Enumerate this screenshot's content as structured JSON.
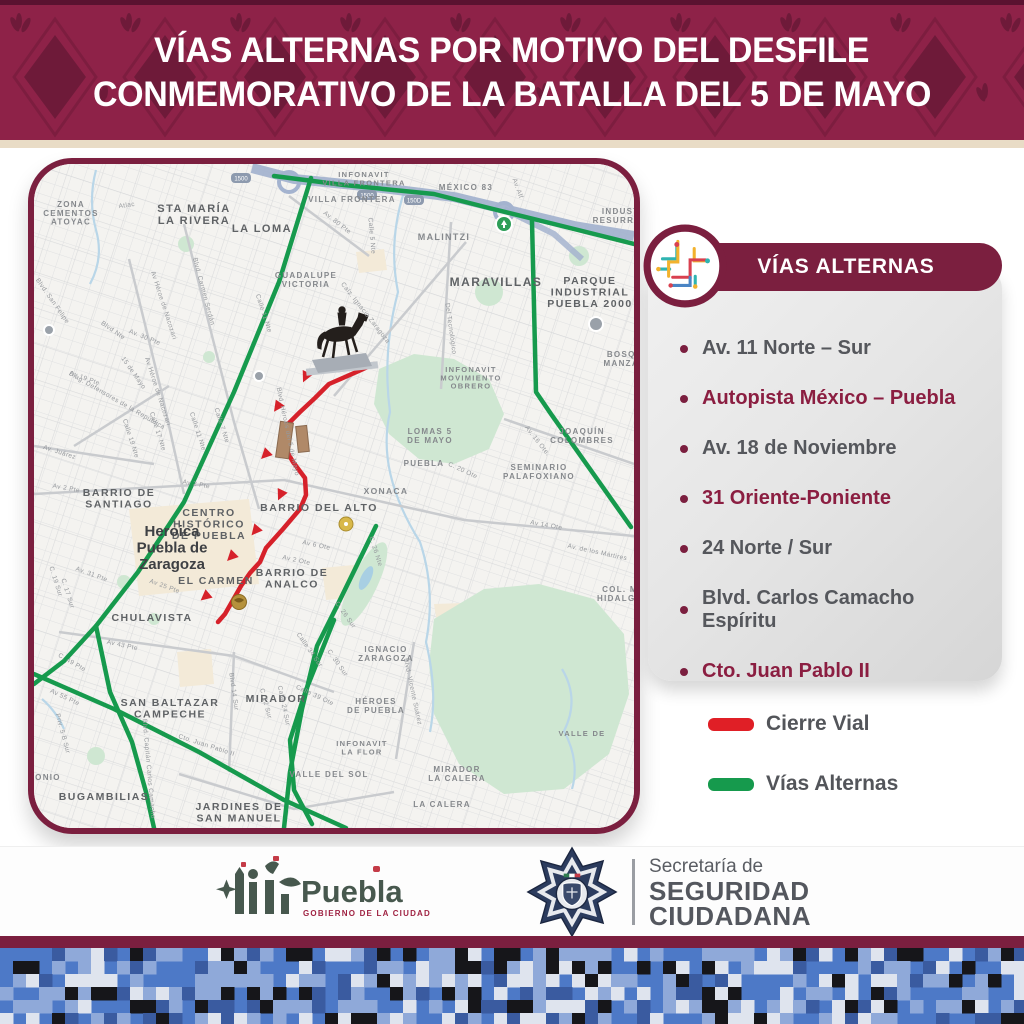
{
  "colors": {
    "maroon": "#7B1F3F",
    "header_bg": "#8E2248",
    "header_pattern": "#6E1A39",
    "cream": "#E9DCC6",
    "closure_red": "#D6212A",
    "alternate_green": "#169A4D",
    "map_bg": "#f4f3f0"
  },
  "header": {
    "title_line1": "VÍAS ALTERNAS POR MOTIVO DEL DESFILE",
    "title_line2": "CONMEMORATIVO DE LA BATALLA DEL 5 DE MAYO"
  },
  "panel": {
    "title": "VÍAS ALTERNAS",
    "items": [
      {
        "label": "Av. 11 Norte – Sur",
        "highlight": false
      },
      {
        "label": "Autopista México – Puebla",
        "highlight": true
      },
      {
        "label": "Av. 18 de Noviembre",
        "highlight": false
      },
      {
        "label": "31 Oriente-Poniente",
        "highlight": true
      },
      {
        "label": "24 Norte / Sur",
        "highlight": false
      },
      {
        "label": "Blvd. Carlos Camacho Espíritu",
        "highlight": false
      },
      {
        "label": "Cto. Juan Pablo II",
        "highlight": true
      }
    ]
  },
  "legend": [
    {
      "label": "Cierre Vial",
      "color": "#E01F26"
    },
    {
      "label": "Vías Alternas",
      "color": "#169A4D"
    }
  ],
  "footer": {
    "puebla": {
      "name": "Puebla",
      "subtitle": "GOBIERNO DE LA CIUDAD"
    },
    "ssc": {
      "line1": "Secretaría de",
      "line2": "SEGURIDAD",
      "line3": "CIUDADANA"
    }
  },
  "map": {
    "city": {
      "t": "Heroica\nPuebla de\nZaragoza",
      "x": 138,
      "y": 372,
      "s": 15
    },
    "routes": {
      "closed": {
        "color": "#D6212A",
        "points": "340,200 327,206 295,220 281,234 266,248 250,264 251,284 259,298 271,314 272,331 266,345 249,365 232,384 226,398 216,409 207,422 199,436 191,450 184,458"
      },
      "arrows": [
        [
          272,
          212,
          205
        ],
        [
          244,
          242,
          215
        ],
        [
          232,
          290,
          225
        ],
        [
          247,
          330,
          205
        ],
        [
          222,
          366,
          220
        ],
        [
          198,
          392,
          225
        ],
        [
          172,
          432,
          230
        ]
      ],
      "alternate": {
        "color": "#169A4D",
        "lines": [
          "240,12 310,21 400,30 455,44 520,60 600,80",
          "498,57 502,228 517,250 597,363",
          "277,14 245,118 200,228 150,338 104,408 62,462 30,497 0,520",
          "62,462 76,528 98,578 112,628 120,664",
          "0,510 80,545 165,588 250,636 312,664",
          "342,362 302,444 283,482 268,545 256,608 250,664",
          "300,456 272,526 256,576 260,626 278,660"
        ]
      }
    },
    "areas": [
      {
        "t": "ZONA\nCEMENTOS\nATOYAC",
        "x": 37,
        "y": 43,
        "s": 8
      },
      {
        "t": "STA MARÍA\nLA RIVERA",
        "x": 160,
        "y": 48,
        "s": 11,
        "b": 1
      },
      {
        "t": "LA LOMA",
        "x": 228,
        "y": 68,
        "s": 11,
        "b": 1
      },
      {
        "t": "INFONAVIT\nVILLA FRONTERA",
        "x": 330,
        "y": 13,
        "s": 7.5
      },
      {
        "t": "VILLA FRONTERA",
        "x": 318,
        "y": 38,
        "s": 8
      },
      {
        "t": "MÉXICO 83",
        "x": 432,
        "y": 26,
        "s": 8
      },
      {
        "t": "MALINTZI",
        "x": 410,
        "y": 76,
        "s": 9
      },
      {
        "t": "MARAVILLAS",
        "x": 462,
        "y": 122,
        "s": 12,
        "b": 1
      },
      {
        "t": "PARQUE\nINDUSTRIAL\nPUEBLA 2000",
        "x": 556,
        "y": 120,
        "s": 10.5,
        "b": 1
      },
      {
        "t": "INDUST.\nRESURREC.",
        "x": 588,
        "y": 50,
        "s": 8
      },
      {
        "t": "GUADALUPE\nVICTORIA",
        "x": 272,
        "y": 114,
        "s": 8
      },
      {
        "t": "BOSQ.\nMANZA.",
        "x": 589,
        "y": 193,
        "s": 8
      },
      {
        "t": "JOAQUÍN\nCOLOMBRES",
        "x": 548,
        "y": 270,
        "s": 8
      },
      {
        "t": "LOMAS 5\nDE MAYO",
        "x": 396,
        "y": 270,
        "s": 8
      },
      {
        "t": "PUEBLA",
        "x": 390,
        "y": 302,
        "s": 8
      },
      {
        "t": "XONACA",
        "x": 352,
        "y": 330,
        "s": 8.5
      },
      {
        "t": "SEMINARIO\nPALAFOXIANO",
        "x": 505,
        "y": 306,
        "s": 8
      },
      {
        "t": "INFONAVIT\nMOVIMIENTO\nOBRERO",
        "x": 437,
        "y": 208,
        "s": 7.5
      },
      {
        "t": "BARRIO DEL ALTO",
        "x": 285,
        "y": 347,
        "s": 10.5,
        "b": 1
      },
      {
        "t": "CENTRO\nHISTÓRICO\nDE PUEBLA",
        "x": 175,
        "y": 352,
        "s": 10.5,
        "b": 1
      },
      {
        "t": "BARRIO DE\nSANTIAGO",
        "x": 85,
        "y": 332,
        "s": 10.5,
        "b": 1
      },
      {
        "t": "EL CARMEN",
        "x": 182,
        "y": 420,
        "s": 10.5,
        "b": 1
      },
      {
        "t": "BARRIO DE\nANALCO",
        "x": 258,
        "y": 412,
        "s": 10.5,
        "b": 1
      },
      {
        "t": "CHULAVISTA",
        "x": 118,
        "y": 457,
        "s": 10.5,
        "b": 1
      },
      {
        "t": "SAN BALTAZAR\nCAMPECHE",
        "x": 136,
        "y": 542,
        "s": 10.5,
        "b": 1
      },
      {
        "t": "MIRADOR",
        "x": 242,
        "y": 538,
        "s": 10.5,
        "b": 1
      },
      {
        "t": "BUGAMBILIAS",
        "x": 70,
        "y": 636,
        "s": 10.5,
        "b": 1
      },
      {
        "t": "JARDINES DE\nSAN MANUEL",
        "x": 205,
        "y": 646,
        "s": 10.5,
        "b": 1
      },
      {
        "t": "IGNACIO\nZARAGOZA",
        "x": 352,
        "y": 488,
        "s": 8
      },
      {
        "t": "HÉROES\nDE PUEBLA",
        "x": 342,
        "y": 540,
        "s": 8
      },
      {
        "t": "INFONAVIT\nLA FLOR",
        "x": 328,
        "y": 582,
        "s": 7.5
      },
      {
        "t": "VALLE DEL SOL",
        "x": 295,
        "y": 613,
        "s": 8
      },
      {
        "t": "MIRADOR\nLA CALERA",
        "x": 423,
        "y": 608,
        "s": 8
      },
      {
        "t": "LA CALERA",
        "x": 408,
        "y": 643,
        "s": 8
      },
      {
        "t": "COL. M\nHIDALGO",
        "x": 586,
        "y": 428,
        "s": 8
      },
      {
        "t": "VALLE DE",
        "x": 548,
        "y": 572,
        "s": 7.5
      },
      {
        "t": "MONIO",
        "x": 10,
        "y": 616,
        "s": 8
      }
    ],
    "streets": [
      {
        "t": "Atlac",
        "x": 93,
        "y": 43,
        "r": -8
      },
      {
        "t": "Av. 80 Pte",
        "x": 302,
        "y": 60,
        "r": 38
      },
      {
        "t": "Calle 5 Nte",
        "x": 336,
        "y": 72,
        "r": 85
      },
      {
        "t": "Blvd. Carmen Serdán",
        "x": 168,
        "y": 128,
        "r": 75
      },
      {
        "t": "Calle 11 Nte",
        "x": 228,
        "y": 150,
        "r": 72
      },
      {
        "t": "Av Héroe de Nacozari",
        "x": 128,
        "y": 142,
        "r": 72
      },
      {
        "t": "Blvd. San Felipe",
        "x": 17,
        "y": 138,
        "r": 55
      },
      {
        "t": "Blvd Nte",
        "x": 78,
        "y": 168,
        "r": 35
      },
      {
        "t": "Av. 30 Pte",
        "x": 110,
        "y": 175,
        "r": 22
      },
      {
        "t": "15 de Mayo",
        "x": 98,
        "y": 210,
        "r": 55
      },
      {
        "t": "Av 19 Pte",
        "x": 50,
        "y": 216,
        "r": 20
      },
      {
        "t": "Calle 11 Nte",
        "x": 162,
        "y": 268,
        "r": 72
      },
      {
        "t": "Av Héroe de Nacozari",
        "x": 122,
        "y": 228,
        "r": 72
      },
      {
        "t": "Calle 7 Nte",
        "x": 186,
        "y": 262,
        "r": 72
      },
      {
        "t": "Calle 17 Nte",
        "x": 122,
        "y": 268,
        "r": 72
      },
      {
        "t": "Calle 19 Nte",
        "x": 95,
        "y": 275,
        "r": 72
      },
      {
        "t": "Diag. Defensores de la República",
        "x": 82,
        "y": 238,
        "r": 30
      },
      {
        "t": "Av. Juárez",
        "x": 25,
        "y": 290,
        "r": 18
      },
      {
        "t": "Av 2 Pte",
        "x": 32,
        "y": 326,
        "r": 10
      },
      {
        "t": "Av 2 Pte",
        "x": 162,
        "y": 322,
        "r": 10
      },
      {
        "t": "Blvd. Héroes del 5 de Mayo",
        "x": 252,
        "y": 268,
        "r": 78
      },
      {
        "t": "Calz. Ignacio Zaragoza",
        "x": 330,
        "y": 150,
        "r": 52
      },
      {
        "t": "Del Tecnológico",
        "x": 415,
        "y": 165,
        "r": 82
      },
      {
        "t": "Av. Alf",
        "x": 482,
        "y": 25,
        "r": 70
      },
      {
        "t": "C. 20 Ote",
        "x": 428,
        "y": 308,
        "r": 25
      },
      {
        "t": "Av. 16 Ote.",
        "x": 502,
        "y": 278,
        "r": 52
      },
      {
        "t": "Av 14 Ote",
        "x": 512,
        "y": 363,
        "r": 10
      },
      {
        "t": "Av. de los Mártires",
        "x": 563,
        "y": 390,
        "r": 12
      },
      {
        "t": "C. 26 Nte",
        "x": 340,
        "y": 388,
        "r": 72
      },
      {
        "t": "Av 6 Ote",
        "x": 282,
        "y": 383,
        "r": 12
      },
      {
        "t": "Av 2 Ote",
        "x": 262,
        "y": 398,
        "r": 12
      },
      {
        "t": "Av 25 Pte",
        "x": 130,
        "y": 424,
        "r": 20
      },
      {
        "t": "C. 19 Sur",
        "x": 20,
        "y": 418,
        "r": 72
      },
      {
        "t": "C. 17 Sur",
        "x": 32,
        "y": 430,
        "r": 72
      },
      {
        "t": "Av. 31 Pte",
        "x": 57,
        "y": 412,
        "r": 20
      },
      {
        "t": "Av 43 Pte",
        "x": 88,
        "y": 483,
        "r": 12
      },
      {
        "t": "C. 49 Pte",
        "x": 37,
        "y": 500,
        "r": 30
      },
      {
        "t": "Av 55 Pte",
        "x": 30,
        "y": 535,
        "r": 25
      },
      {
        "t": "Priv. 5 B Sur",
        "x": 27,
        "y": 570,
        "r": 75
      },
      {
        "t": "Blvd 14 Sur",
        "x": 198,
        "y": 528,
        "r": 82
      },
      {
        "t": "C. 22 Sur",
        "x": 230,
        "y": 540,
        "r": 75
      },
      {
        "t": "Calle 24 Sur",
        "x": 248,
        "y": 542,
        "r": 78
      },
      {
        "t": "Calle 39 Ote",
        "x": 280,
        "y": 533,
        "r": 25
      },
      {
        "t": "Calle 34 Sur",
        "x": 274,
        "y": 487,
        "r": 55
      },
      {
        "t": "Blvd. Capitán Carlos Camacho",
        "x": 113,
        "y": 605,
        "r": 85
      },
      {
        "t": "Cto. Juan Pablo II",
        "x": 172,
        "y": 583,
        "r": 18
      },
      {
        "t": "Blvd. Vicente Suárez",
        "x": 377,
        "y": 528,
        "r": 78
      },
      {
        "t": "C. 26 Sur",
        "x": 310,
        "y": 452,
        "r": 55
      },
      {
        "t": "C. 30 Sur",
        "x": 302,
        "y": 500,
        "r": 55
      }
    ],
    "shields": [
      {
        "t": "1500",
        "x": 207,
        "y": 14
      },
      {
        "t": "1500",
        "x": 333,
        "y": 31
      },
      {
        "t": "150D",
        "x": 380,
        "y": 36
      }
    ]
  }
}
